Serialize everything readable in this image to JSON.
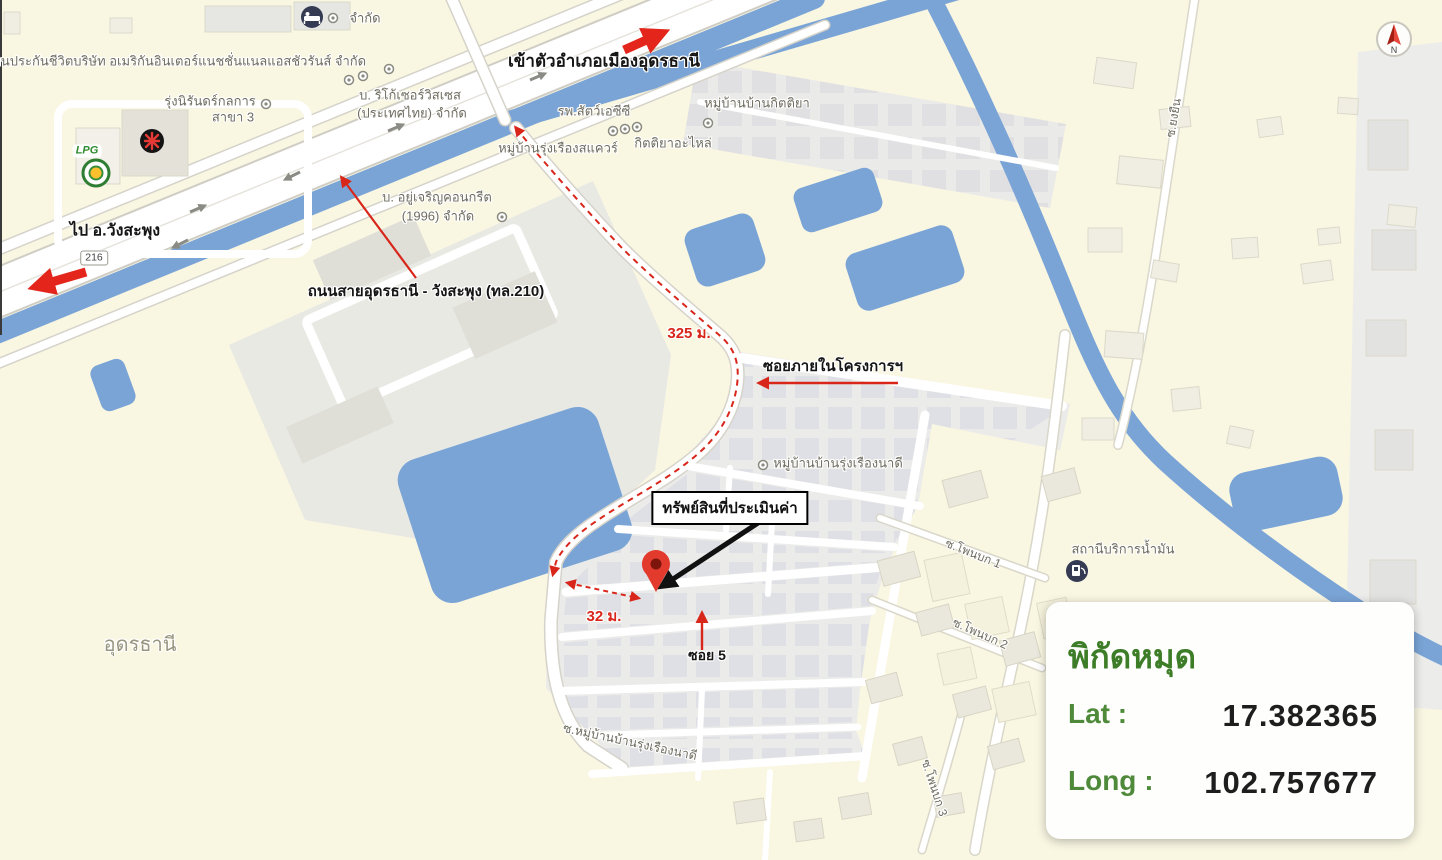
{
  "map_labels": {
    "insurance_company": "แทนประกันชีวิตบริษัท อเมริกันอินเตอร์แนชชั่นแนลแอสชัวรันส์ จำกัด",
    "rung_niran": "รุ่งนิรันดร์กลการ",
    "rung_niran_branch": "สาขา 3",
    "limited": "จำกัด",
    "ricoh_line1": "บ. ริโก้เซอร์วิสเซส",
    "ricoh_line2": "(ประเทศไทย) จำกัด",
    "to_mueang_udon": "เข้าตัวอำเภอเมืองอุดรธานี",
    "animal_hospital": "รพ.สัตว์เอซีซี",
    "kittiya_village": "หมู่บ้านบ้านกิตติยา",
    "rungruang_square": "หมู่บ้านรุ่งเรืองสแควร์",
    "kittiya_parts": "กิตติยาอะไหล่",
    "concrete_line1": "บ. อยู่เจริญคอนกรีต",
    "concrete_line2": "(1996) จำกัด",
    "to_wang_saphung": "ไป อ.วังสะพุง",
    "route_badge": "216",
    "road_name": "ถนนสายอุดรธานี - วังสะพุง (ทล.210)",
    "distance_325": "325 ม.",
    "project_soi": "ซอยภายในโครงการฯ",
    "rungruang_nadee_village": "หมู่บ้านบ้านรุ่งเรืองนาดี",
    "property_box": "ทรัพย์สินที่ประเมินค่า",
    "distance_32": "32 ม.",
    "soi_5": "ซอย 5",
    "gas_station": "สถานีบริการน้ำมัน",
    "phon_bok_1": "ซ.โพนบก 1",
    "phon_bok_2": "ซ.โพนบก 2",
    "phon_bok_3": "ซ.โพนบก 3",
    "soi_rungruang_nadee": "ซ.หมู่บ้านบ้านรุ่งเรืองนาดี",
    "yong_yuen": "ซ.ยงยืน",
    "udon_thani": "อุดรธานี",
    "lpg": "LPG"
  },
  "coordinate_card": {
    "title": "พิกัดหมุด",
    "lat_label": "Lat :",
    "lat_value": "17.382365",
    "long_label": "Long :",
    "long_value": "102.757677"
  },
  "compass": {
    "north_letter": "N"
  },
  "colors": {
    "map_background": "#F9F6E2",
    "water_blue": "#7AA4D6",
    "annotation_red": "#D8261A",
    "coordinate_green": "#3E7D28",
    "label_gray": "#6F6D60",
    "estate_gray": "#EBEBE9"
  }
}
